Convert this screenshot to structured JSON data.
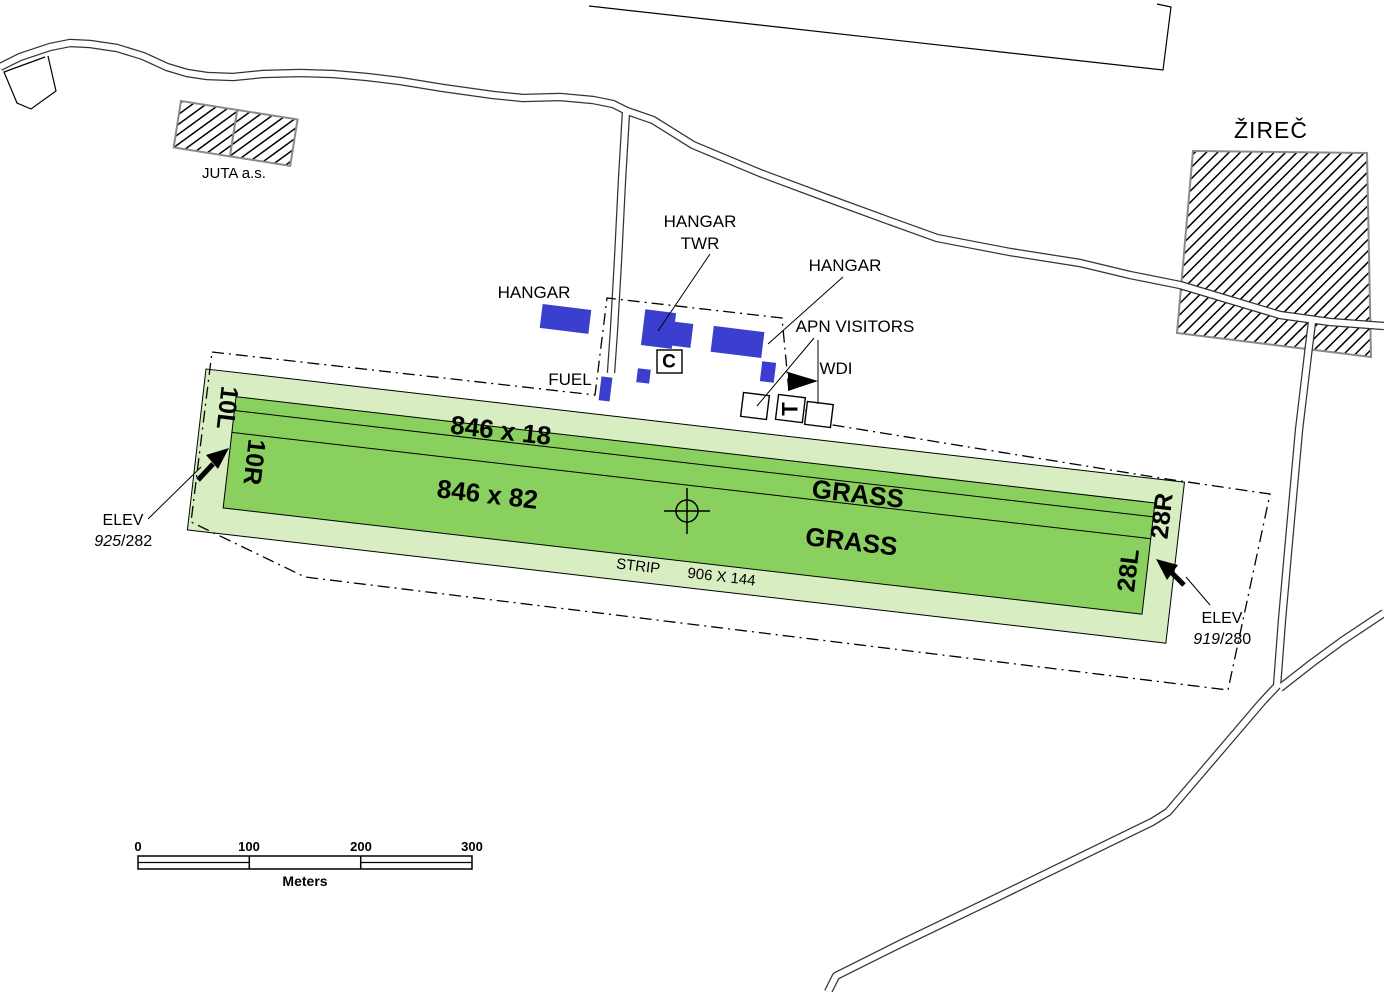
{
  "colors": {
    "strip_green": "#d9edc2",
    "runway_green": "#8ad05f",
    "building_blue": "#3a3fd0"
  },
  "town_label": "ŽIREČ",
  "factory_label": "JUTA a.s.",
  "labels": {
    "hangar_west": "HANGAR",
    "hangar_tower_line1": "HANGAR",
    "hangar_tower_line2": "TWR",
    "hangar_east": "HANGAR",
    "apron": "APN VISITORS",
    "wind_indicator": "WDI",
    "fuel": "FUEL",
    "signal_area": "C",
    "landing_tee": "T"
  },
  "runway": {
    "rwy_small_dims": "846 x 18",
    "rwy_large_dims": "846 x 82",
    "grass_upper": "GRASS",
    "grass_lower": "GRASS",
    "strip_word": "STRIP",
    "strip_dims": "906 X 144",
    "designators": {
      "left_outer": "10L",
      "left_inner": "10R",
      "right_outer": "28R",
      "right_inner": "28L"
    },
    "elev_west": {
      "label": "ELEV",
      "feet": "925",
      "meters": "/282"
    },
    "elev_east": {
      "label": "ELEV",
      "feet": "919",
      "meters": "/280"
    }
  },
  "scale_bar": {
    "tick0": "0",
    "tick1": "100",
    "tick2": "200",
    "tick3": "300",
    "unit": "Meters"
  }
}
